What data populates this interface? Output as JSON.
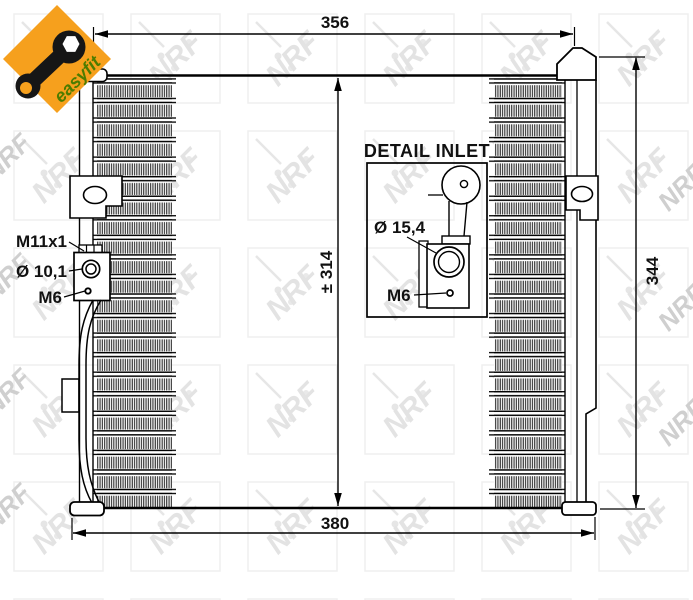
{
  "logo": {
    "brand": "easyfit",
    "orange": "#F6A01D",
    "green": "#4C7C00"
  },
  "watermark": {
    "brand": "NRF"
  },
  "dimensions": {
    "width_top": "356",
    "width_bottom": "380",
    "core_height": "± 314",
    "overall_height": "344"
  },
  "port_labels": {
    "thread": "M11x1",
    "diameter": "Ø 10,1",
    "bolt": "M6"
  },
  "detail_inset": {
    "title": "DETAIL INLET",
    "diameter": "Ø 15,4",
    "bolt": "M6"
  }
}
